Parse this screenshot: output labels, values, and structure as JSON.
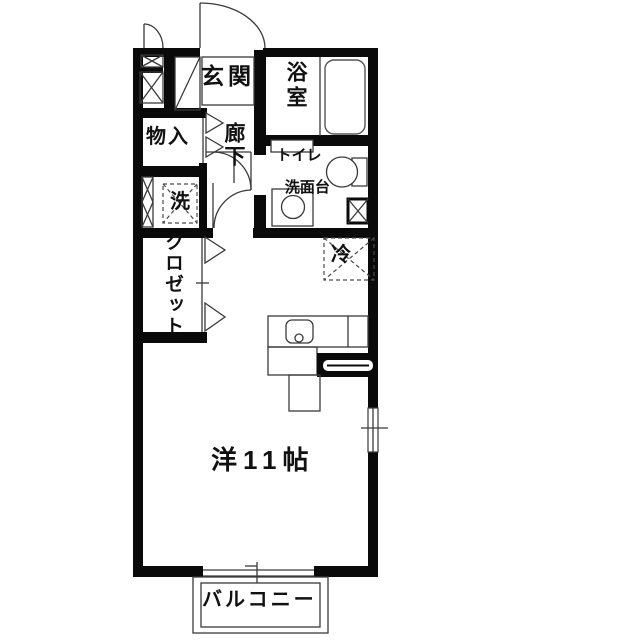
{
  "floorplan": {
    "type": "apartment-1R-floor-plan",
    "rooms": {
      "entrance": {
        "label": "玄関"
      },
      "bathroom": {
        "label": "浴室"
      },
      "hallway": {
        "label": "廊下"
      },
      "storage": {
        "label": "物入"
      },
      "laundry": {
        "label": "洗"
      },
      "toilet_vanity": {
        "label_line1": "トイレ",
        "label_line2": "洗面台"
      },
      "closet": {
        "label": "クロゼット"
      },
      "refrigerator": {
        "label": "冷"
      },
      "main_room": {
        "label": "洋11帖"
      },
      "balcony": {
        "label": "バルコニー"
      }
    },
    "colors": {
      "background": "#ffffff",
      "wall": "#0a0a0a",
      "thin_line": "#3a3a3a",
      "text": "#111111"
    }
  }
}
